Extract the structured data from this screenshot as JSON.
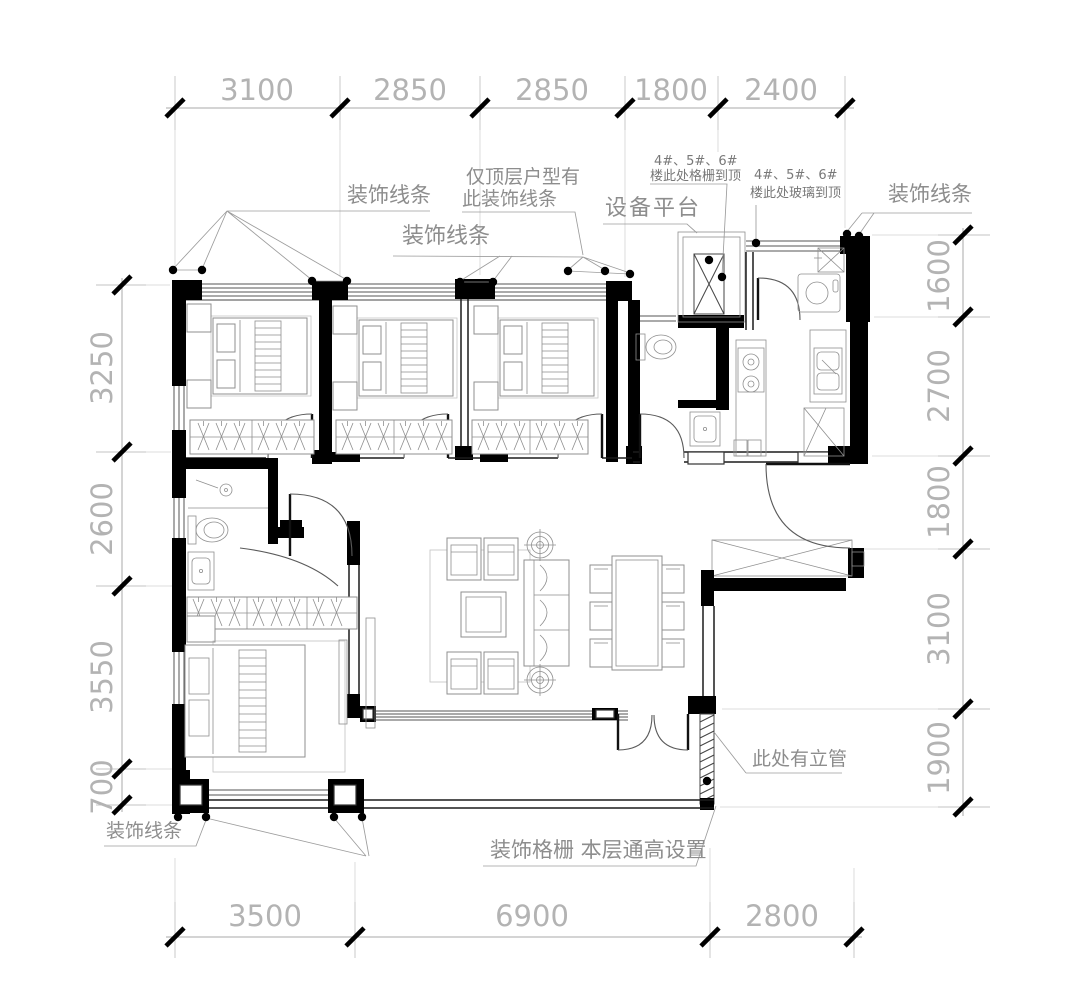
{
  "drawing": {
    "type": "apartment-floor-plan"
  },
  "dimensions": {
    "top": [
      "3100",
      "2850",
      "2850",
      "1800",
      "2400"
    ],
    "bottom": [
      "3500",
      "6900",
      "2800"
    ],
    "left": [
      "3250",
      "2600",
      "3550",
      "700"
    ],
    "right": [
      "1600",
      "2700",
      "1800",
      "3100",
      "1900"
    ]
  },
  "labels": {
    "deco_top_left": "装饰线条",
    "deco_top_mid": "装饰线条",
    "deco_top_right": "装饰线条",
    "deco_bottom_left": "装饰线条",
    "top_floor_note_1": "仅顶层户型有",
    "top_floor_note_2": "此装饰线条",
    "equipment_platform": "设备平台",
    "grille_note_1": "4#、5#、6#",
    "grille_note_2": "楼此处格栅到顶",
    "glass_note_1": "4#、5#、6#",
    "glass_note_2": "楼此处玻璃到顶",
    "riser_note": "此处有立管",
    "bottom_grille_note": "装饰格栅 本层通高设置"
  }
}
